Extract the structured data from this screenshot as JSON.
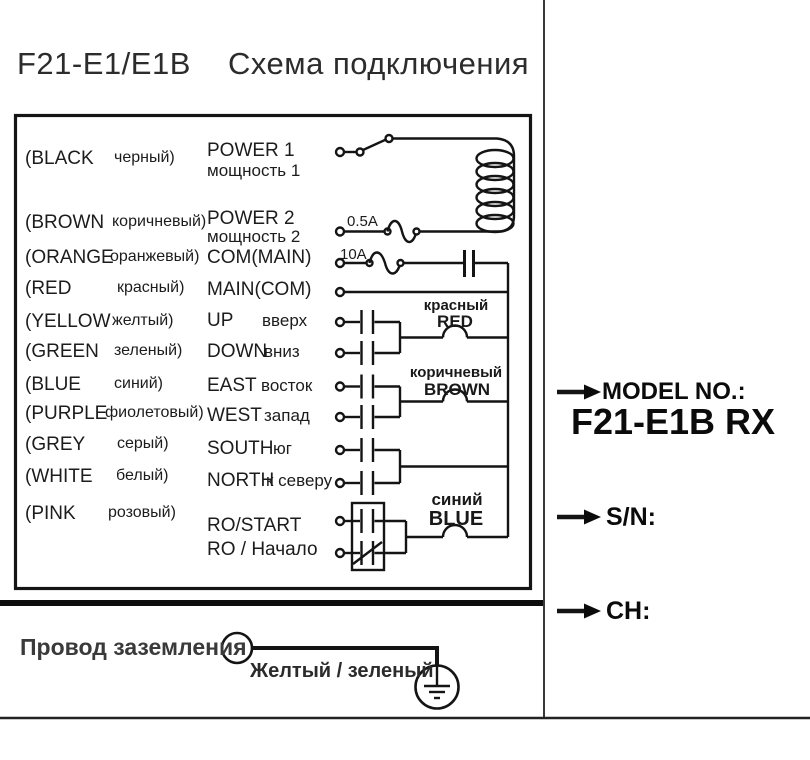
{
  "title": {
    "model": "F21-E1/E1B",
    "heading": "Схема подключения"
  },
  "legend": {
    "rows": [
      {
        "color": "(BLACK",
        "color_ru": "черный)",
        "func": "POWER 1",
        "func_ru": "мощность 1"
      },
      {
        "color": "(BROWN",
        "color_ru": "коричневый)",
        "func": "POWER 2",
        "func_ru": "мощность 2"
      },
      {
        "color": "(ORANGE",
        "color_ru": "оранжевый)",
        "func": "COM(MAIN)",
        "func_ru": ""
      },
      {
        "color": "(RED",
        "color_ru": "красный)",
        "func": "MAIN(COM)",
        "func_ru": ""
      },
      {
        "color": "(YELLOW",
        "color_ru": "желтый)",
        "func": "UP",
        "func_ru": "вверх"
      },
      {
        "color": "(GREEN",
        "color_ru": "зеленый)",
        "func": "DOWN",
        "func_ru": "вниз"
      },
      {
        "color": "(BLUE",
        "color_ru": "синий)",
        "func": "EAST",
        "func_ru": "восток"
      },
      {
        "color": "(PURPLE",
        "color_ru": "фиолетовый)",
        "func": "WEST",
        "func_ru": "запад"
      },
      {
        "color": "(GREY",
        "color_ru": "серый)",
        "func": "SOUTH",
        "func_ru": "юг"
      },
      {
        "color": "(WHITE",
        "color_ru": "белый)",
        "func": "NORTH",
        "func_ru": "к северу"
      },
      {
        "color": "(PINK",
        "color_ru": "розовый)",
        "func": "RO/START",
        "func_ru": "RO / Начало"
      }
    ]
  },
  "circuit": {
    "fuse_small": "0.5A",
    "fuse_big": "10A",
    "wire_labels": [
      {
        "ru": "красный",
        "en": "RED"
      },
      {
        "ru": "коричневый",
        "en": "BROWN"
      },
      {
        "ru": "синий",
        "en": "BLUE"
      }
    ]
  },
  "ground": {
    "label": "Провод заземления",
    "wire_color": "Желтый / зеленый"
  },
  "right_panel": {
    "model_label": "MODEL NO.:",
    "model_value": "F21-E1B RX",
    "serial_label": "S/N:",
    "channel_label": "CH:"
  },
  "colors": {
    "ink": "#1c1c1c",
    "line": "#141414"
  }
}
